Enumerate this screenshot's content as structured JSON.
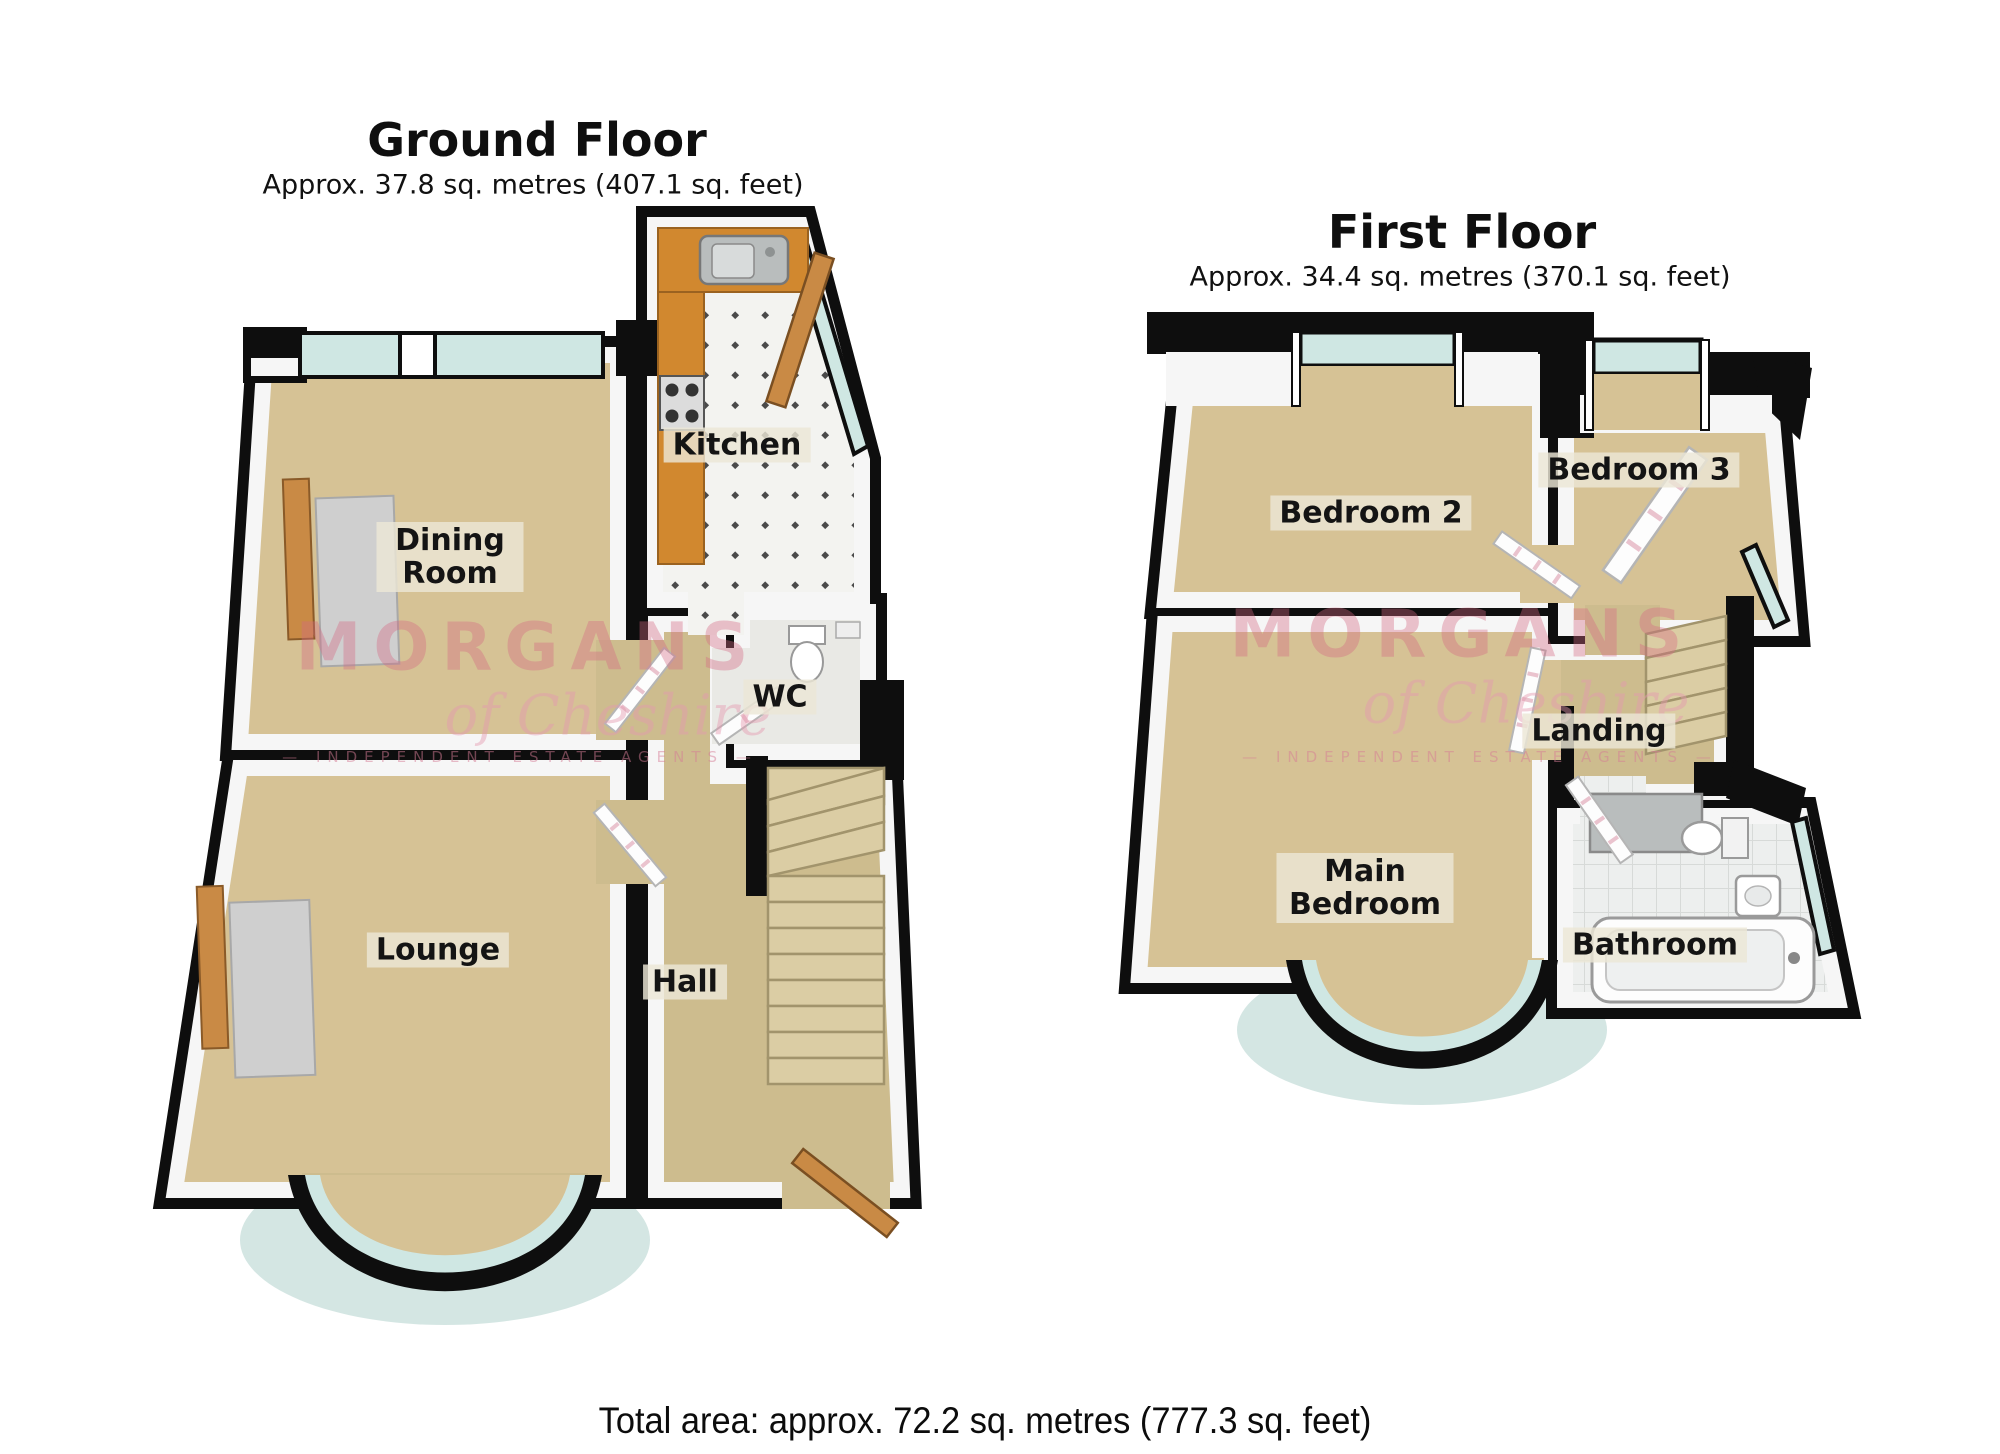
{
  "ground_floor": {
    "title": "Ground Floor",
    "subtitle": "Approx. 37.8 sq. metres (407.1 sq. feet)",
    "rooms": {
      "dining_room": "Dining Room",
      "kitchen": "Kitchen",
      "wc": "WC",
      "lounge": "Lounge",
      "hall": "Hall"
    }
  },
  "first_floor": {
    "title": "First Floor",
    "subtitle": "Approx. 34.4 sq. metres (370.1 sq. feet)",
    "rooms": {
      "bedroom2": "Bedroom 2",
      "bedroom3": "Bedroom 3",
      "landing": "Landing",
      "main_bedroom": "Main Bedroom",
      "bathroom": "Bathroom"
    }
  },
  "watermark": {
    "brand": "MORGANS",
    "script": "of Cheshire",
    "caps": "— INDEPENDENT ESTATE AGENTS —"
  },
  "footer": {
    "total_area": "Total area: approx. 72.2 sq. metres (777.3 sq. feet)"
  },
  "colors": {
    "carpet": "#d6c295",
    "hall_carpet": "#cdbc8e",
    "wall": "#0e0e0e",
    "window_glass": "#cfe7e3",
    "counter": "#d1882f",
    "stairs": "#dbcda4",
    "watermark_pink": "#d56883",
    "label_bg": "#ece7d6"
  }
}
